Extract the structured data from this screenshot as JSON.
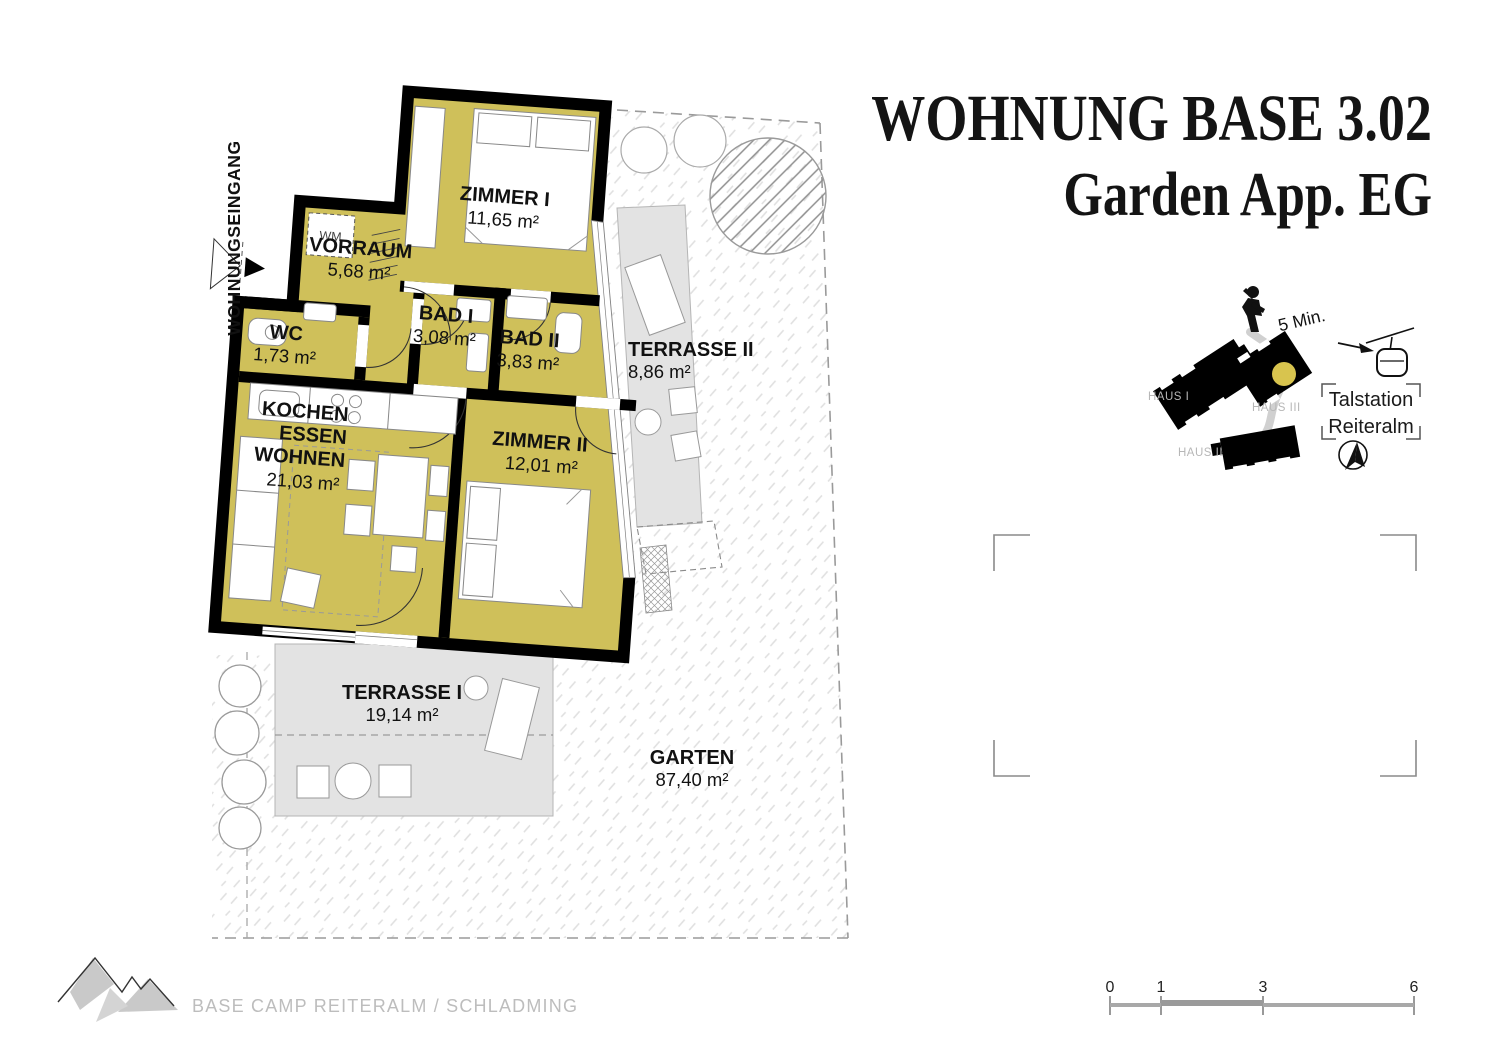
{
  "title": {
    "line1": "WOHNUNG BASE 3.02",
    "line2": "Garden App. EG"
  },
  "plan": {
    "entrance_label": "WOHNUNGSEINGANG",
    "washer_label": "WM",
    "rooms": {
      "zimmer1": {
        "name": "ZIMMER I",
        "area": "11,65 m²"
      },
      "vorraum": {
        "name": "VORRAUM",
        "area": "5,68 m²"
      },
      "bad1": {
        "name": "BAD I",
        "area": "3,08 m²"
      },
      "bad2": {
        "name": "BAD II",
        "area": "3,83 m²"
      },
      "wc": {
        "name": "WC",
        "area": "1,73 m²"
      },
      "wohnen": {
        "line1": "KOCHEN",
        "line2": "ESSEN",
        "line3": "WOHNEN",
        "area": "21,03 m²"
      },
      "zimmer2": {
        "name": "ZIMMER II",
        "area": "12,01 m²"
      },
      "terrasse2": {
        "name": "TERRASSE II",
        "area": "8,86 m²"
      },
      "terrasse1": {
        "name": "TERRASSE I",
        "area": "19,14 m²"
      },
      "garten": {
        "name": "GARTEN",
        "area": "87,40 m²"
      }
    }
  },
  "site_map": {
    "walk_time": "5 Min.",
    "haus1_label": "HAUS I",
    "haus2_label": "HAUS II",
    "haus3_label": "HAUS III",
    "station_line1": "Talstation",
    "station_line2": "Reiteralm"
  },
  "scale_bar": {
    "tick0": "0",
    "tick1": "1",
    "tick2": "3",
    "tick3": "6"
  },
  "footer": {
    "project": "BASE CAMP REITERALM / SCHLADMING"
  },
  "colors": {
    "room_fill": "#cfc05a",
    "wall": "#000000",
    "terrace_fill": "#e3e3e3",
    "unit_marker": "#d8c44e",
    "boundary_dash": "#9a9a9a"
  }
}
